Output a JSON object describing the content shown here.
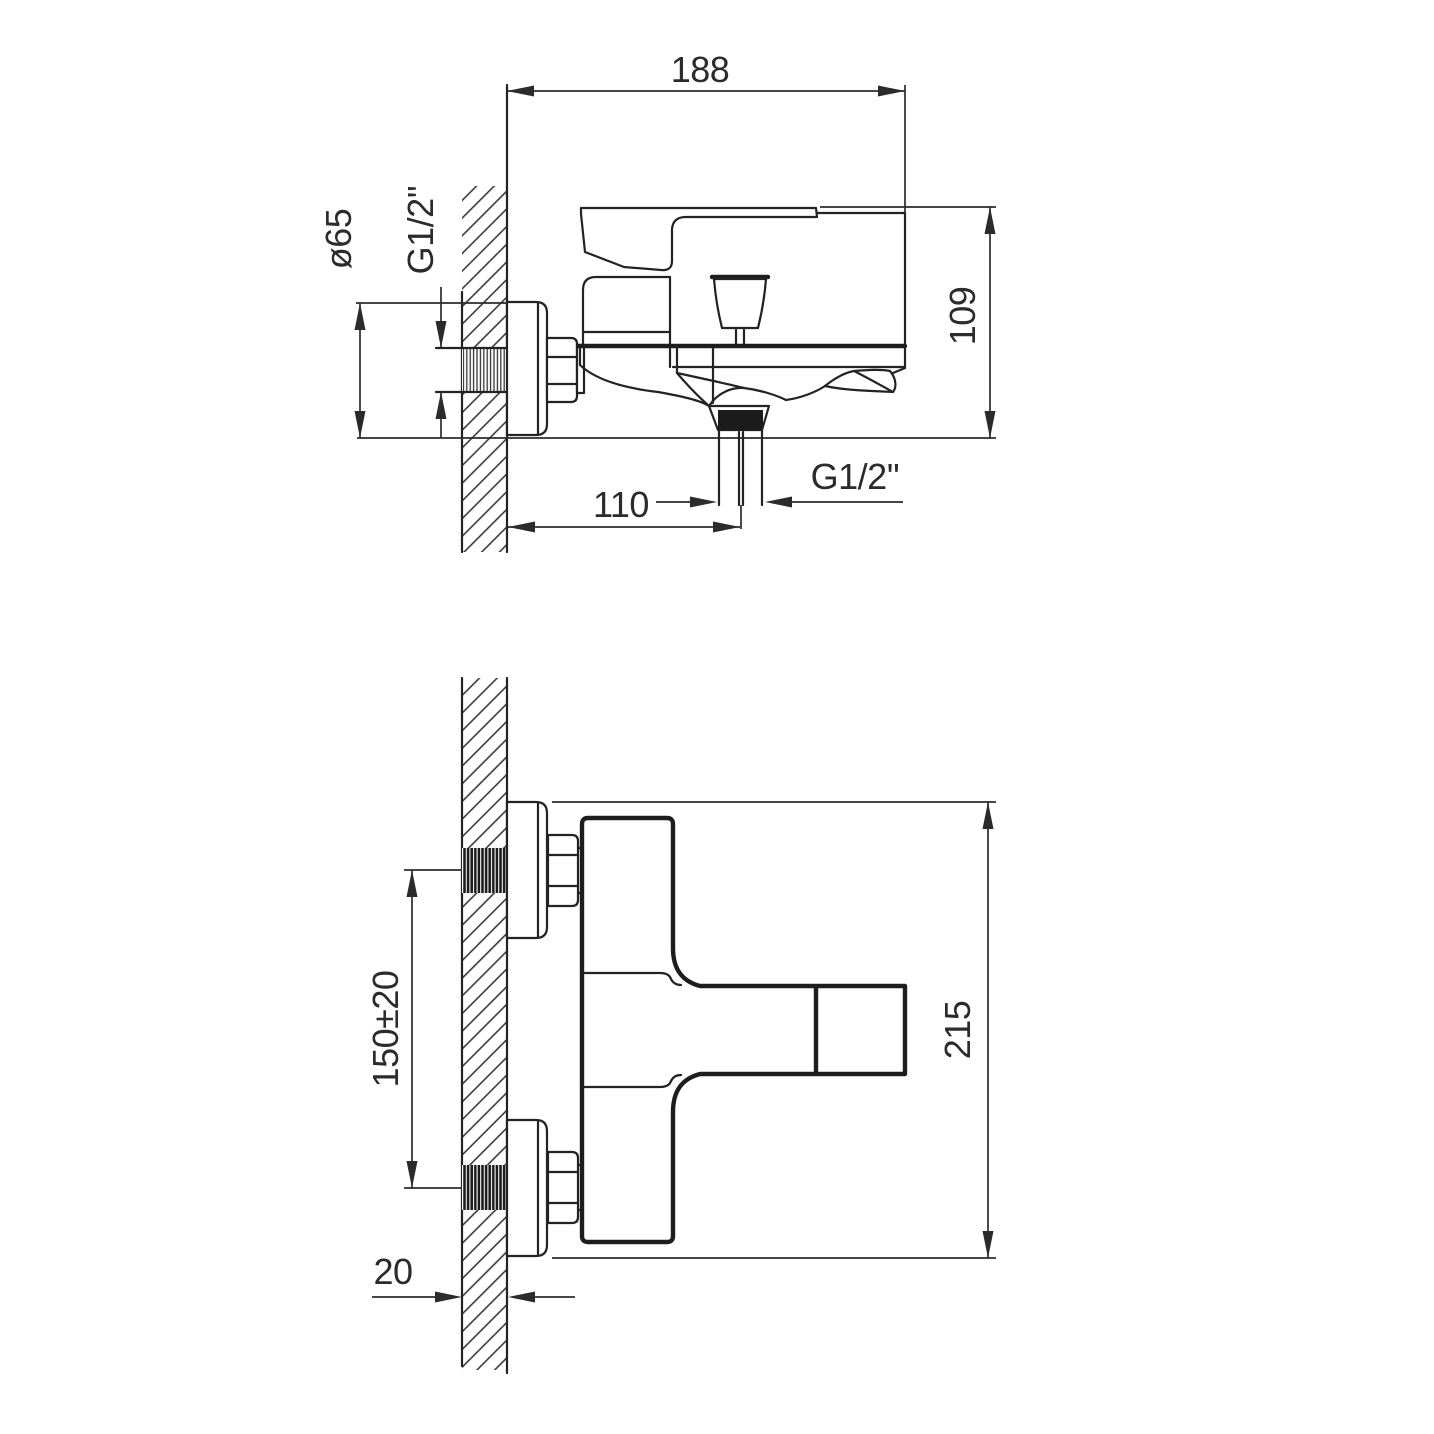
{
  "drawing": {
    "type": "technical dimension drawing",
    "subject": "wall-mounted single-lever bath shower mixer",
    "background_color": "#ffffff",
    "line_color": "#232323",
    "side_view": {
      "label": "side view",
      "dims": {
        "overall_depth": "188",
        "escutcheon_diameter": "ø65",
        "inlet_thread": "G1/2''",
        "overall_height": "109",
        "spout_reach": "110",
        "outlet_thread": "G1/2''"
      }
    },
    "front_view": {
      "label": "front view",
      "dims": {
        "inlet_spacing": "150±20",
        "overall_width": "215",
        "wall_thickness": "20"
      }
    }
  }
}
